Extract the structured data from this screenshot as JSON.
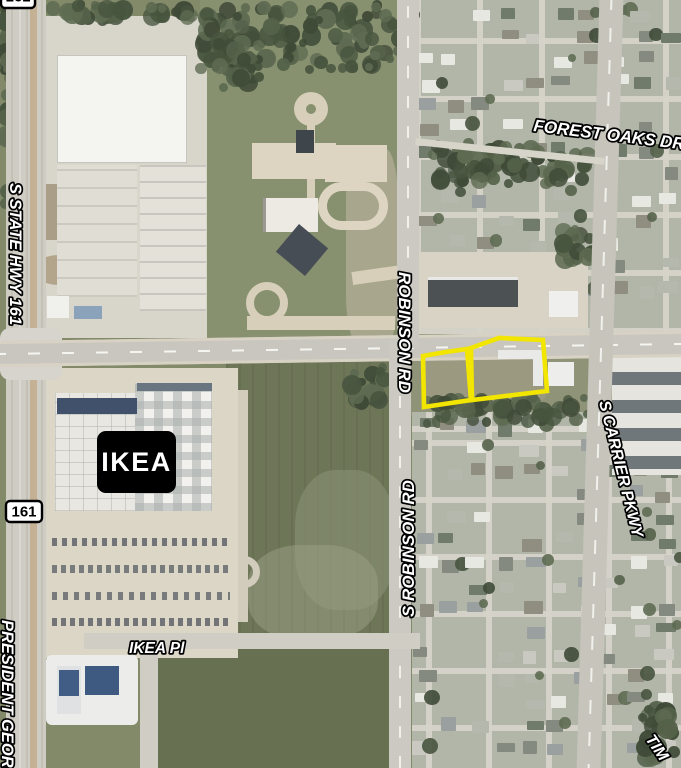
{
  "map_labels": {
    "s_state_hwy_161": "S STATE HWY 161",
    "president_george": "PRESIDENT GEORGE",
    "robinson_rd": "ROBINSON RD",
    "s_robinson_rd": "S ROBINSON RD",
    "forest_oaks_dr": "FOREST OAKS DR",
    "s_carrier_pkwy": "S CARRIER PKWY",
    "ikea_pl": "IKEA Pl",
    "tim_partial": "TIM",
    "poi_ikea": "IKEA",
    "shield_left": "161",
    "shield_top": "161"
  },
  "parcels": {
    "count": 2,
    "outline_color": "#f2e600",
    "left_points": "423,356 446,352 467,349 471,400 424,407",
    "right_points": "471,348 499,338 543,340 547,391 472,400"
  },
  "colors": {
    "label_fill": "#ffffff",
    "label_stroke": "#000000",
    "ikea_badge_bg": "#000000",
    "ikea_badge_text": "#ffffff",
    "shield_bg": "#ffffff",
    "shield_border": "#000000"
  }
}
